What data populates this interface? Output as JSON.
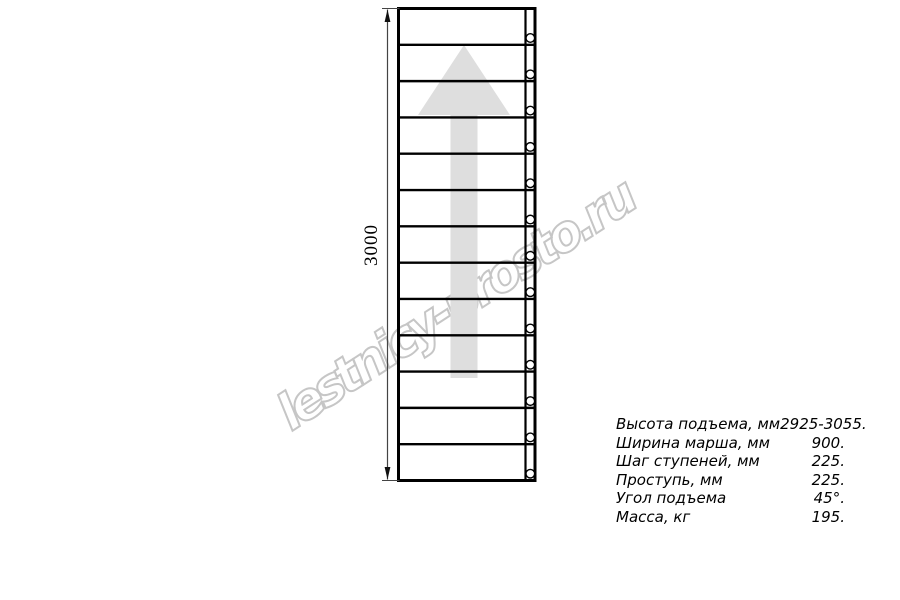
{
  "drawing": {
    "dimension_label": "3000",
    "steps_count": 13,
    "bolts_count": 13,
    "arrow_color": "#dedede",
    "line_color": "#000000",
    "dimension_line_color": "#444444"
  },
  "watermark": {
    "text": "lestnicy-prosto.ru",
    "color": "#c6c6c6"
  },
  "specs": {
    "rows": [
      {
        "label": "Высота подъема, мм",
        "value": "2925-3055."
      },
      {
        "label": "Ширина марша, мм",
        "value": "900."
      },
      {
        "label": "Шаг ступеней, мм",
        "value": "225."
      },
      {
        "label": "Проступь, мм",
        "value": "225."
      },
      {
        "label": "Угол подъема",
        "value": "45°."
      },
      {
        "label": "Масса, кг",
        "value": "195."
      }
    ]
  }
}
